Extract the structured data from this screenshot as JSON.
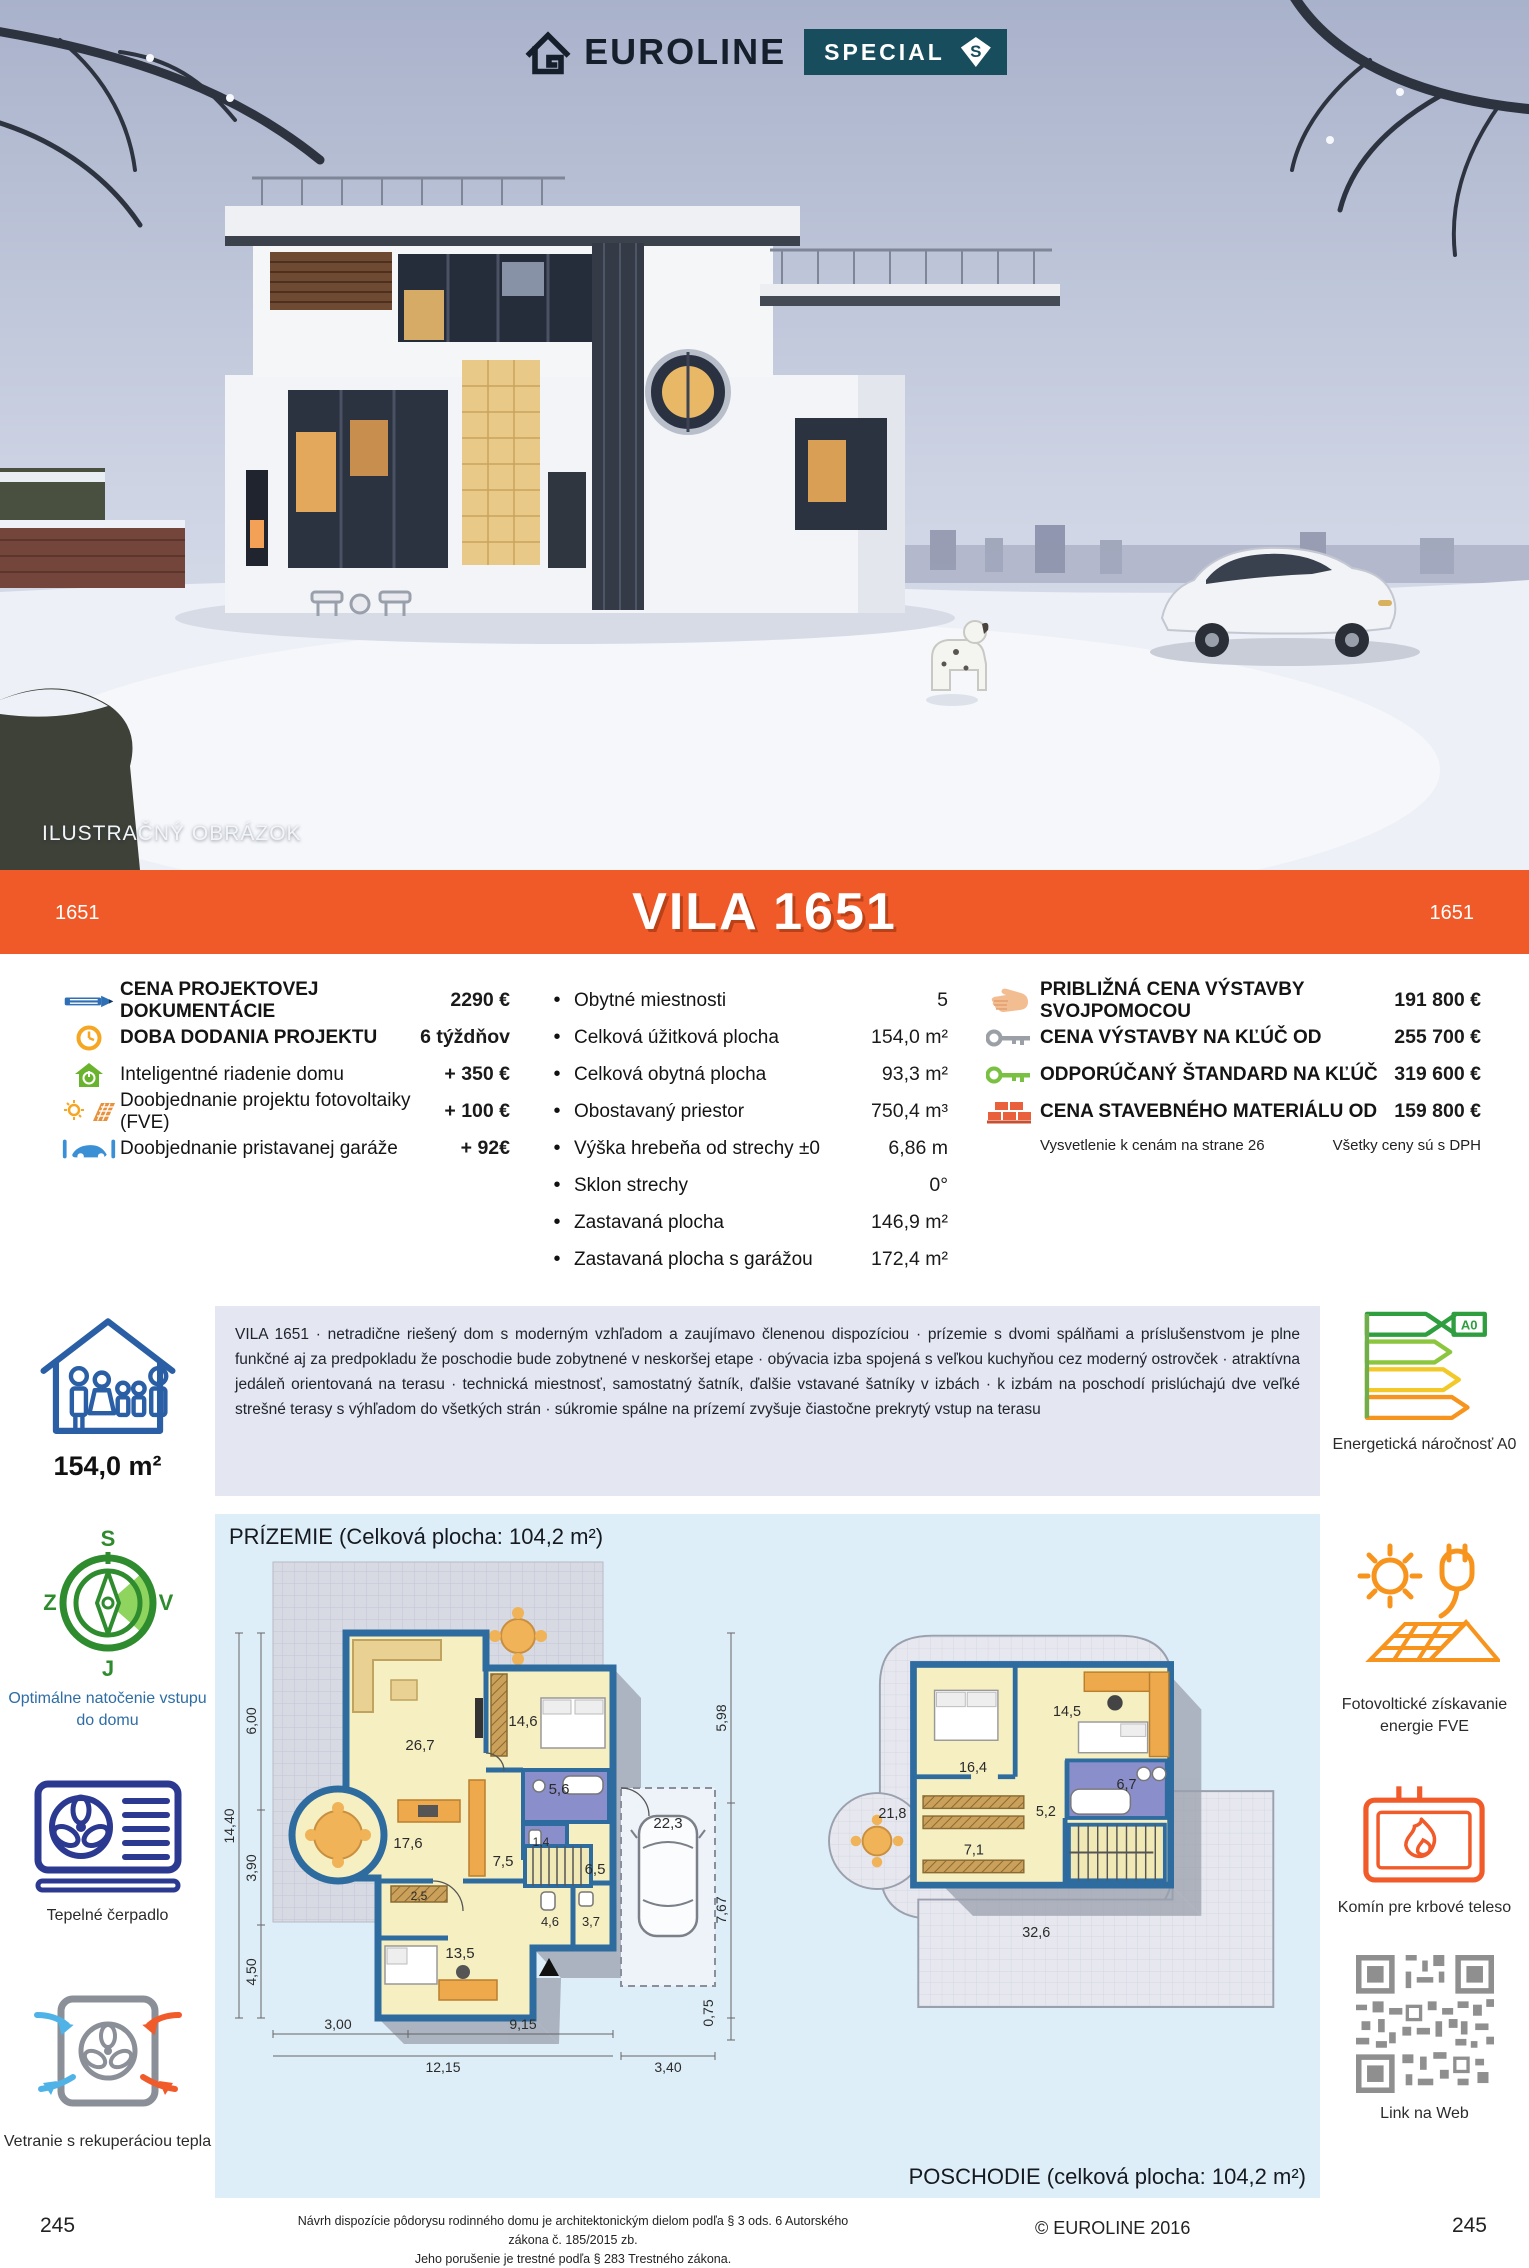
{
  "colors": {
    "accent_orange": "#f05a28",
    "badge_teal": "#174d5c",
    "wall_blue": "#2e6b9e",
    "desc_bg": "#e4e7f2",
    "plan_bg": "#ddeef8"
  },
  "logo": {
    "brand": "EUROLINE",
    "badge": "SPECIAL",
    "badge_s": "S"
  },
  "photo": {
    "caption": "ILUSTRAČNÝ OBRÁZOK"
  },
  "banner": {
    "left_code": "1651",
    "title": "VILA 1651",
    "right_code": "1651"
  },
  "specs": {
    "left": [
      {
        "icon": "pencil-icon",
        "label": "CENA PROJEKTOVEJ DOKUMENTÁCIE",
        "value": "2290 €"
      },
      {
        "icon": "clock-icon",
        "label": "DOBA DODANIA PROJEKTU",
        "value": "6 týždňov"
      },
      {
        "icon": "smart-home-icon",
        "label": "Inteligentné riadenie domu",
        "value": "+ 350 €"
      },
      {
        "icon": "solar-icon",
        "label": "Doobjednanie projektu fotovoltaiky (FVE)",
        "value": "+ 100 €"
      },
      {
        "icon": "garage-icon",
        "label": "Doobjednanie pristavanej garáže",
        "value": "+ 92€"
      }
    ],
    "middle": [
      {
        "label": "Obytné miestnosti",
        "value": "5"
      },
      {
        "label": "Celková úžitková plocha",
        "value": "154,0 m²"
      },
      {
        "label": "Celková obytná plocha",
        "value": "93,3 m²"
      },
      {
        "label": "Obostavaný priestor",
        "value": "750,4 m³"
      },
      {
        "label": "Výška hrebeňa od strechy ±0",
        "value": "6,86 m"
      },
      {
        "label": "Sklon strechy",
        "value": "0°"
      },
      {
        "label": "Zastavaná plocha",
        "value": "146,9 m²"
      },
      {
        "label": "Zastavaná plocha s garážou",
        "value": "172,4 m²"
      }
    ],
    "right": [
      {
        "icon": "hand-icon",
        "label": "PRIBLIŽNÁ CENA VÝSTAVBY SVOJPOMOCOU",
        "value": "191 800 €"
      },
      {
        "icon": "key-gray-icon",
        "label": "CENA VÝSTAVBY NA KĽÚČ OD",
        "value": "255 700 €"
      },
      {
        "icon": "key-green-icon",
        "label": "ODPORÚČANÝ ŠTANDARD NA KĽÚČ",
        "value": "319 600 €"
      },
      {
        "icon": "bricks-icon",
        "label": "CENA STAVEBNÉHO MATERIÁLU OD",
        "value": "159 800 €"
      }
    ],
    "note_left": "Vysvetlenie k cenám na strane 26",
    "note_right": "Všetky ceny sú s DPH"
  },
  "summary": {
    "area": "154,0 m²"
  },
  "description": "VILA 1651 · netradične riešený dom s moderným vzhľadom a zaujímavo členenou dispozíciou · prízemie s dvomi spálňami a príslušenstvom je plne funkčné aj za predpokladu že poschodie bude zobytnené v neskoršej etape · obývacia izba spojená s veľkou kuchyňou cez moderný ostrovček · atraktívna jedáleň orientovaná na terasu · technická miestnosť, samostatný šatník, ďalšie vstavané šatníky v izbách · k izbám na poschodí prislúchajú dve veľké strešné terasy s výhľadom do všetkých strán · súkromie spálne na prízemí zvyšuje čiastočne prekrytý vstup na terasu",
  "energy": {
    "label": "A0",
    "caption": "Energetická náročnosť A0"
  },
  "left_rail": {
    "compass": {
      "n": "S",
      "w": "Z",
      "e": "V",
      "s": "J",
      "caption": "Optimálne natočenie vstupu do domu"
    },
    "heatpump_caption": "Tepelné čerpadlo",
    "ventilation_caption": "Vetranie s rekuperáciou tepla"
  },
  "right_rail": {
    "pv_caption": "Fotovoltické získavanie energie FVE",
    "chimney_caption": "Komín pre krbové teleso",
    "qr_caption": "Link na Web"
  },
  "floorplans": {
    "ground": {
      "title": "PRÍZEMIE (Celková plocha: 104,2 m²)",
      "rooms": [
        "26,7",
        "14,6",
        "5,6",
        "1,4",
        "17,6",
        "7,5",
        "6,5",
        "2,5",
        "4,6",
        "3,7",
        "13,5",
        "22,3"
      ],
      "dims": {
        "v1": "6,00",
        "v2": "3,90",
        "v3": "4,50",
        "v_total": "14,40",
        "b1": "3,00",
        "b2": "9,15",
        "b3": "12,15",
        "b4": "3,40",
        "r1": "5,98",
        "r2": "7,67",
        "r3": "0,75"
      }
    },
    "upper": {
      "title": "POSCHODIE (celková plocha: 104,2 m²)",
      "rooms": [
        "16,4",
        "14,5",
        "6,7",
        "5,2",
        "7,1",
        "21,8",
        "32,6"
      ]
    }
  },
  "footer": {
    "legal1": "Návrh dispozície pôdorysu rodinného domu je architektonickým dielom podľa § 3 ods. 6 Autorského zákona č. 185/2015 zb.",
    "legal2": "Jeho porušenie je trestné podľa § 283 Trestného zákona.",
    "copyright": "© EUROLINE 2016",
    "page_left": "245",
    "page_right": "245"
  }
}
